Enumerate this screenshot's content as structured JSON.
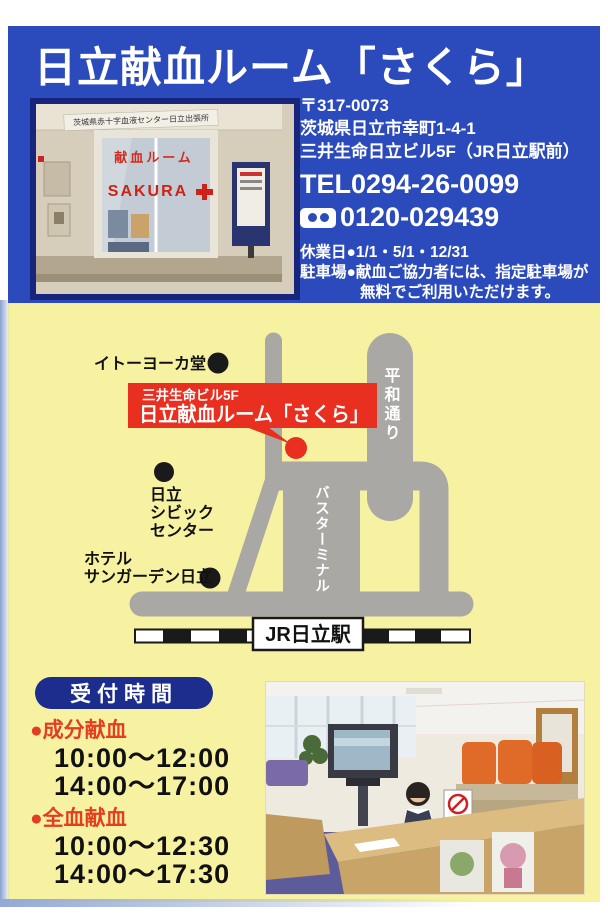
{
  "title": "日立献血ルーム「さくら」",
  "contact": {
    "postal": "〒317-0073",
    "address1": "茨城県日立市幸町1-4-1",
    "address2": "三井生命日立ビル5F（JR日立駅前）",
    "tel": "TEL0294-26-0099",
    "freedial": "0120-029439",
    "closed": "休業日●1/1・5/1・12/31",
    "parking1": "駐車場●献血ご協力者には、指定駐車場が",
    "parking2": "無料でご利用いただけます。"
  },
  "entrance_photo": {
    "sign": "茨城県赤十字血液センター日立出張所",
    "door_text": "献血ルーム",
    "brand": "SAKURA"
  },
  "map": {
    "itoyokado": "イトーヨーカ堂",
    "building": "三井生命ビル5F",
    "room": "日立献血ルーム「さくら」",
    "heiwa_street": "平和通り",
    "bus_terminal": "バスターミナル",
    "civic": [
      "日立",
      "シビック",
      "センター"
    ],
    "hotel": [
      "ホテル",
      "サンガーデン日立"
    ],
    "station": "JR日立駅"
  },
  "hours": {
    "heading": "受付時間",
    "groups": [
      {
        "label": "●成分献血",
        "times": [
          "10:00～12:00",
          "14:00～17:00"
        ]
      },
      {
        "label": "●全血献血",
        "times": [
          "10:00～12:30",
          "14:00～17:30"
        ]
      }
    ]
  },
  "colors": {
    "header_blue": "#2b4abc",
    "body_yellow": "#f7f2a2",
    "road_gray": "#a9a8a4",
    "highlight_red": "#e92f1f",
    "badge_navy": "#1d2d8e",
    "accent_red_text": "#e63c20"
  }
}
